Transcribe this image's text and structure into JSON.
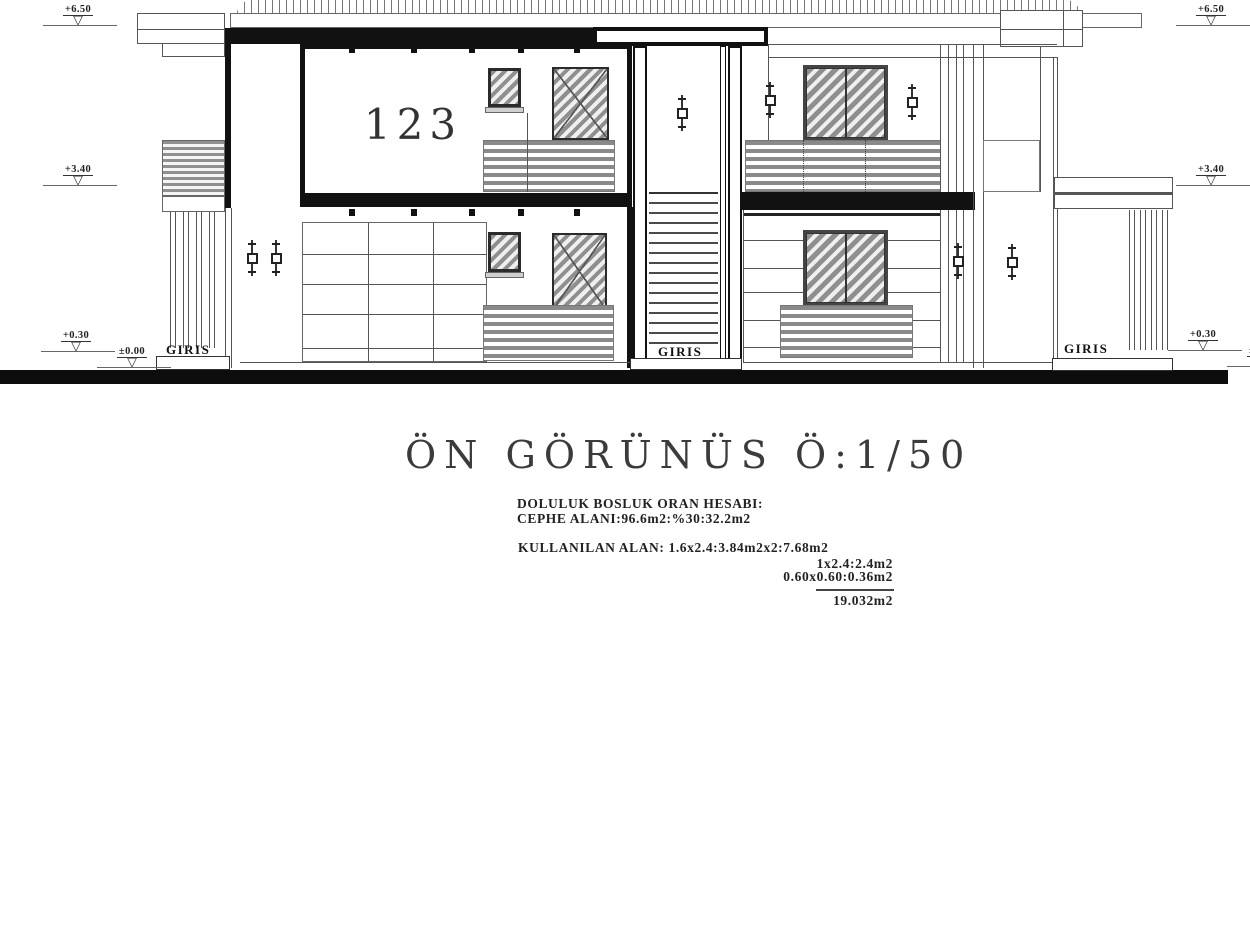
{
  "title": {
    "text": "ÖN GÖRÜNÜS Ö:1/50"
  },
  "room": {
    "number": "123"
  },
  "entrances": {
    "left": "GIRIS",
    "center": "GIRIS",
    "right": "GIRIS"
  },
  "markers": {
    "left_top": "+6.50",
    "left_mid": "+3.40",
    "left_low": "+0.30",
    "left_ground": "±0.00",
    "right_top": "+6.50",
    "right_mid": "+3.40",
    "right_low": "+0.30",
    "right_ground": "±0.00"
  },
  "icons": {
    "level_triangle": "▽"
  },
  "calculations": {
    "heading": "DOLULUK BOSLUK ORAN HESABI:",
    "facade": "CEPHE ALANI:96.6m2:%30:32.2m2",
    "used_area": "KULLANILAN ALAN: 1.6x2.4:3.84m2x2:7.68m2",
    "row2": "1x2.4:2.4m2",
    "row3": "0.60x0.60:0.36m2",
    "total": "19.032m2"
  },
  "colors": {
    "ink": "#111111",
    "hatch": "#8f8f8f",
    "ground_bar": "#0d0d0d"
  }
}
